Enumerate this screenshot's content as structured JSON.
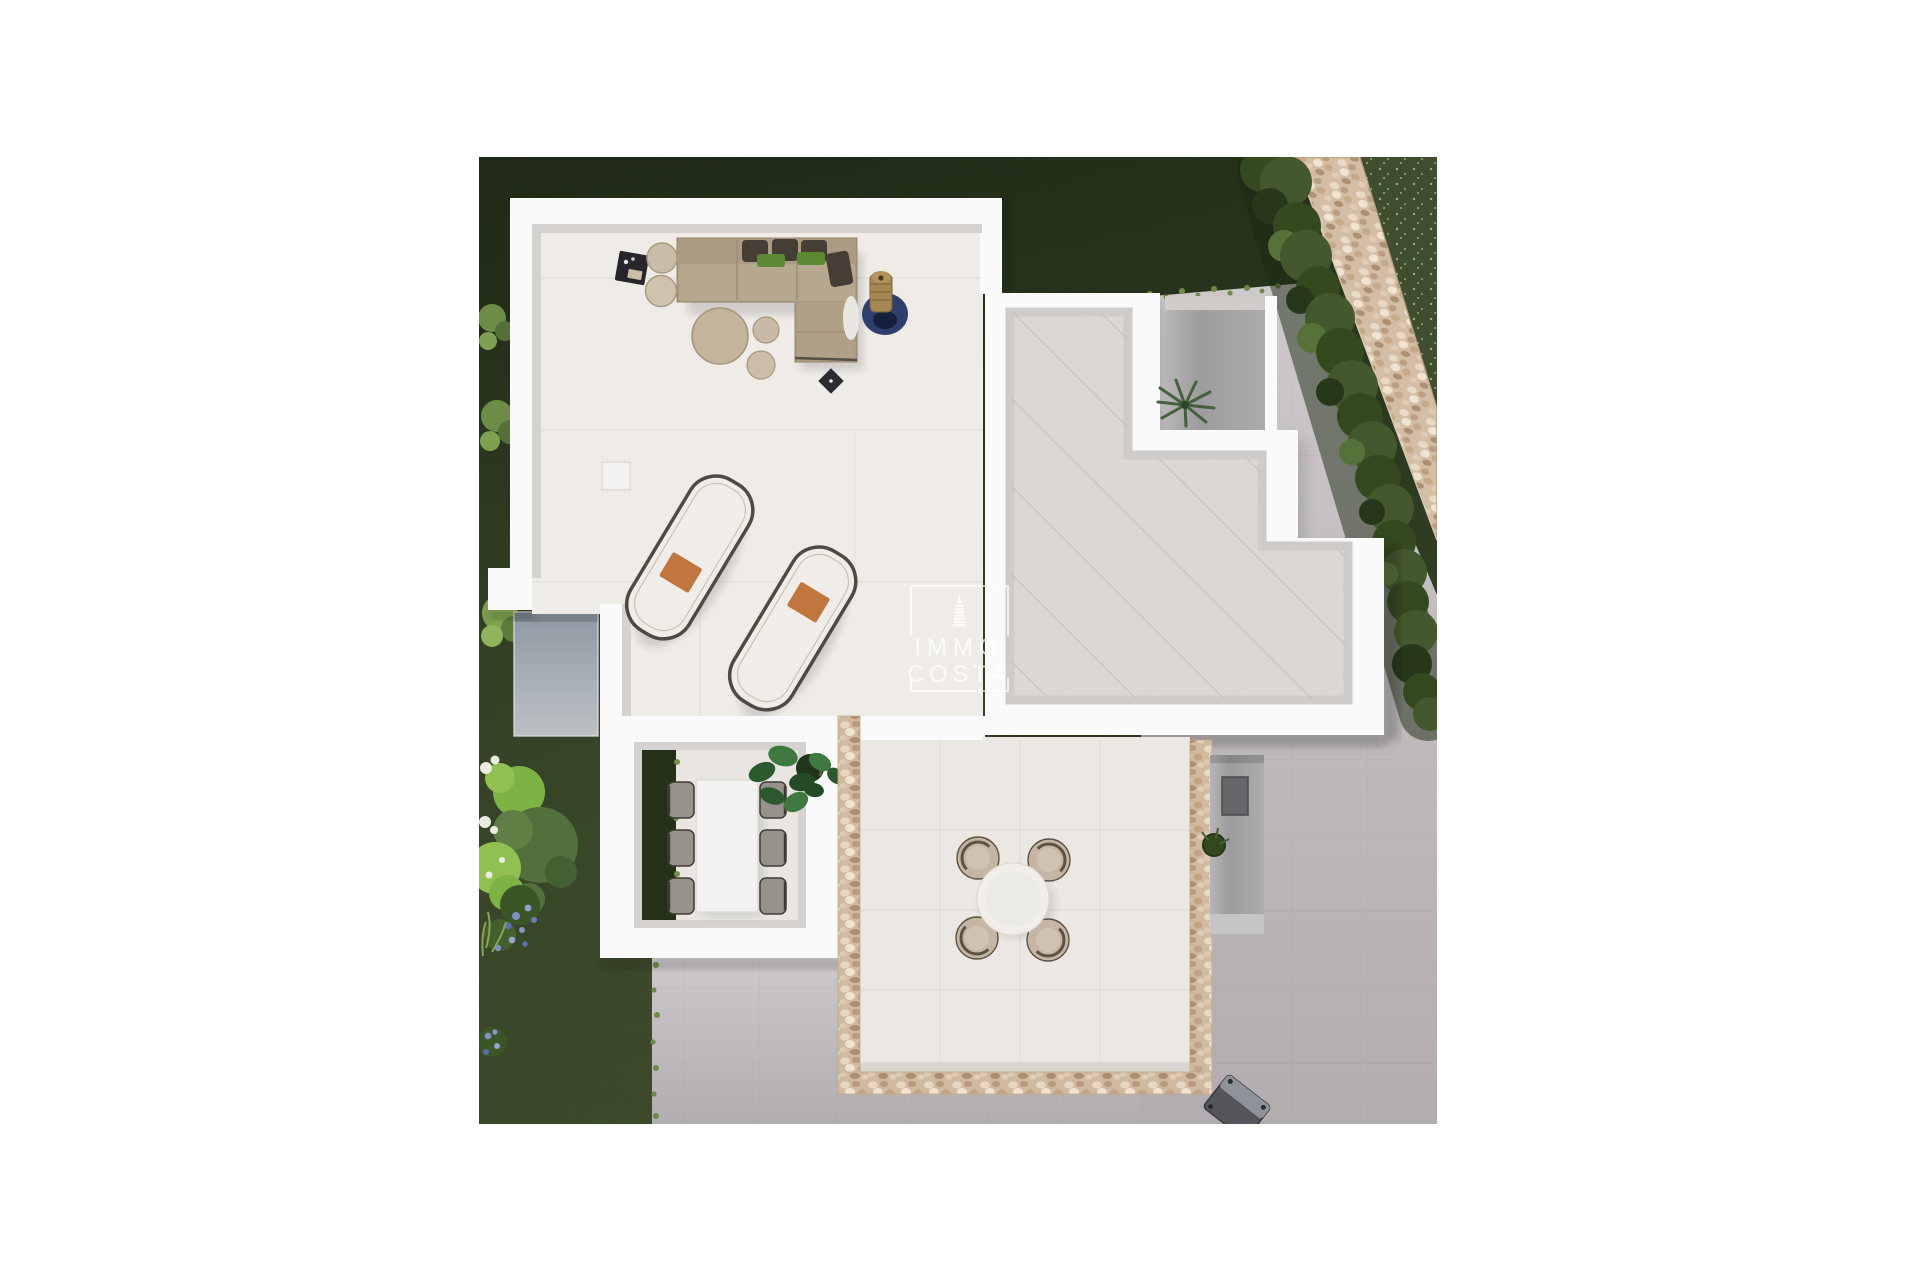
{
  "watermark": {
    "line1": "IMMO",
    "line2": "COSTA",
    "icon": "lighthouse-icon"
  },
  "palette": {
    "page_bg": "#ffffff",
    "grass_top": "#1f2a15",
    "grass_mid": "#2a3a1e",
    "grass_low": "#3b4929",
    "grass_speckle_base": "#3e4e2f",
    "hedge_dark": "#27371a",
    "hedge_mid": "#35491f",
    "hedge_green": "#44582e",
    "hedge_light": "#567239",
    "path_stone": "#cfb99f",
    "concrete_light": "#cdc9cb",
    "concrete_dark": "#b4afb2",
    "wall_white": "#fbfafa",
    "wall_face": "#d5d2d0",
    "terrace_floor": "#efece8",
    "tile_floor": "#dcd7d2",
    "patio_floor": "#ebe8e4",
    "stone_border": "#d8c5ae",
    "sunken_blue": "#98a1ab",
    "sofa_tan": "#ab9b83",
    "sofa_seat": "#b6a78f",
    "cushion_dark": "#453e35",
    "pillow_green": "#5c8a33",
    "rug_blue": "#2e3f6d",
    "planter_brown": "#a58754",
    "pouf_beige": "#c3b49e",
    "lounger_white": "#f0ede9",
    "lounger_frame": "#4f4943",
    "towel_orange": "#c0763c",
    "chair_gray": "#98928c",
    "chair_frame": "#3f3a35",
    "table_white": "#f3f2f0",
    "patio_chair": "#c4b6a3",
    "patio_chair_frame": "#5a5244",
    "plant_green": "#33602f",
    "pot_dark": "#22341b",
    "flower_blue": "#7d8fc4",
    "recess_gray": "#a3a0a3",
    "grill_gray": "#54555b",
    "watermark_white": "#ffffff"
  }
}
